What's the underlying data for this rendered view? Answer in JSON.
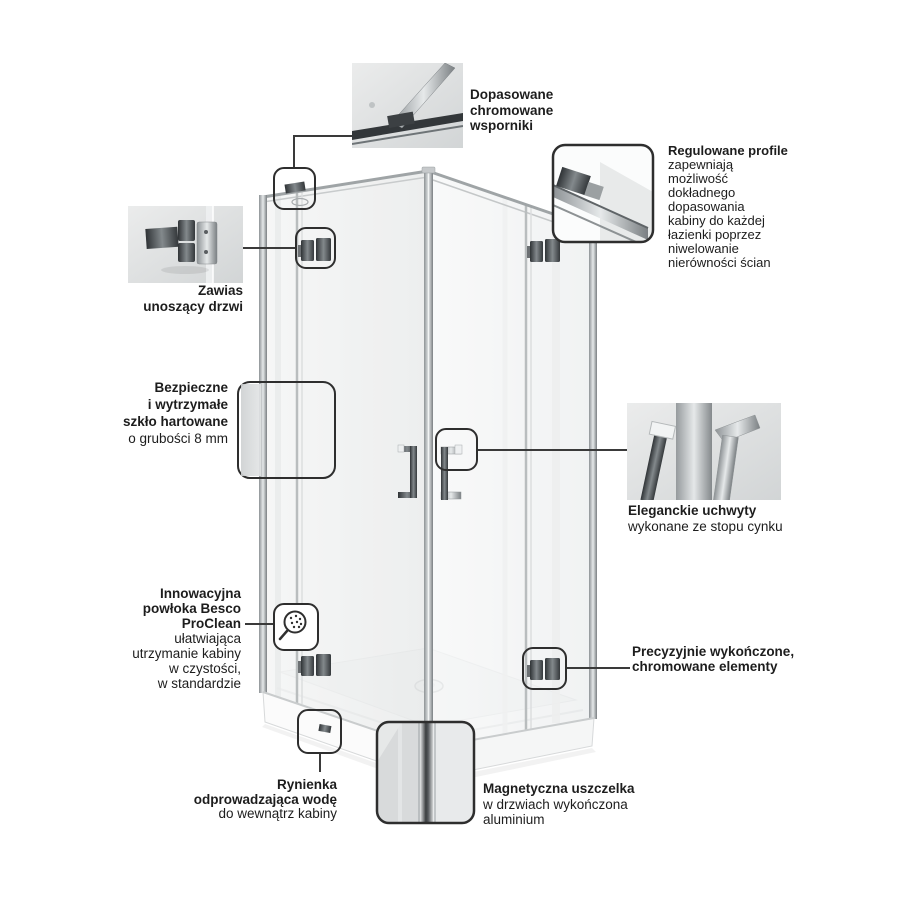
{
  "page": {
    "type": "product-feature-infographic",
    "product": "corner shower enclosure (kabina prysznicowa)",
    "background": "#ffffff"
  },
  "colors": {
    "text": "#1d1d1d",
    "connector_line": "#3a3a3a",
    "highlight_border": "#2e2e2e",
    "chrome_dark": "#44484b",
    "chrome_light": "#d9dcdd",
    "glass_tint": "#eef0f0"
  },
  "callouts": {
    "brackets": {
      "bold": "Dopasowane\nchromowane\nwsporniki",
      "regular": ""
    },
    "profiles": {
      "bold": "Regulowane profile",
      "regular": "zapewniają\nmożliwość\ndokładnego\ndopasowania\nkabiny do każdej\nłazienki poprzez\nniwelowanie\nnierówności ścian"
    },
    "hinge": {
      "bold": "Zawias\nunoszący drzwi",
      "regular": ""
    },
    "glass": {
      "bold": "Bezpieczne\ni wytrzymałe\nszkło hartowane",
      "regular": "o grubości 8 mm"
    },
    "handles": {
      "bold": "Eleganckie uchwyty",
      "regular": "wykonane ze stopu cynku"
    },
    "proclean": {
      "bold": "Innowacyjna\npowłoka Besco\nProClean",
      "regular": "ułatwiająca\nutrzymanie kabiny\nw czystości,\nw standardzie"
    },
    "chrome_elements": {
      "bold": "Precyzyjnie wykończone,\nchromowane elementy",
      "regular": ""
    },
    "drain_channel": {
      "bold": "Rynienka\nodprowadzająca wodę",
      "regular": "do wewnątrz kabiny"
    },
    "magnet_seal": {
      "bold": "Magnetyczna uszczelka",
      "regular": "w drzwiach wykończona\naluminium"
    }
  }
}
